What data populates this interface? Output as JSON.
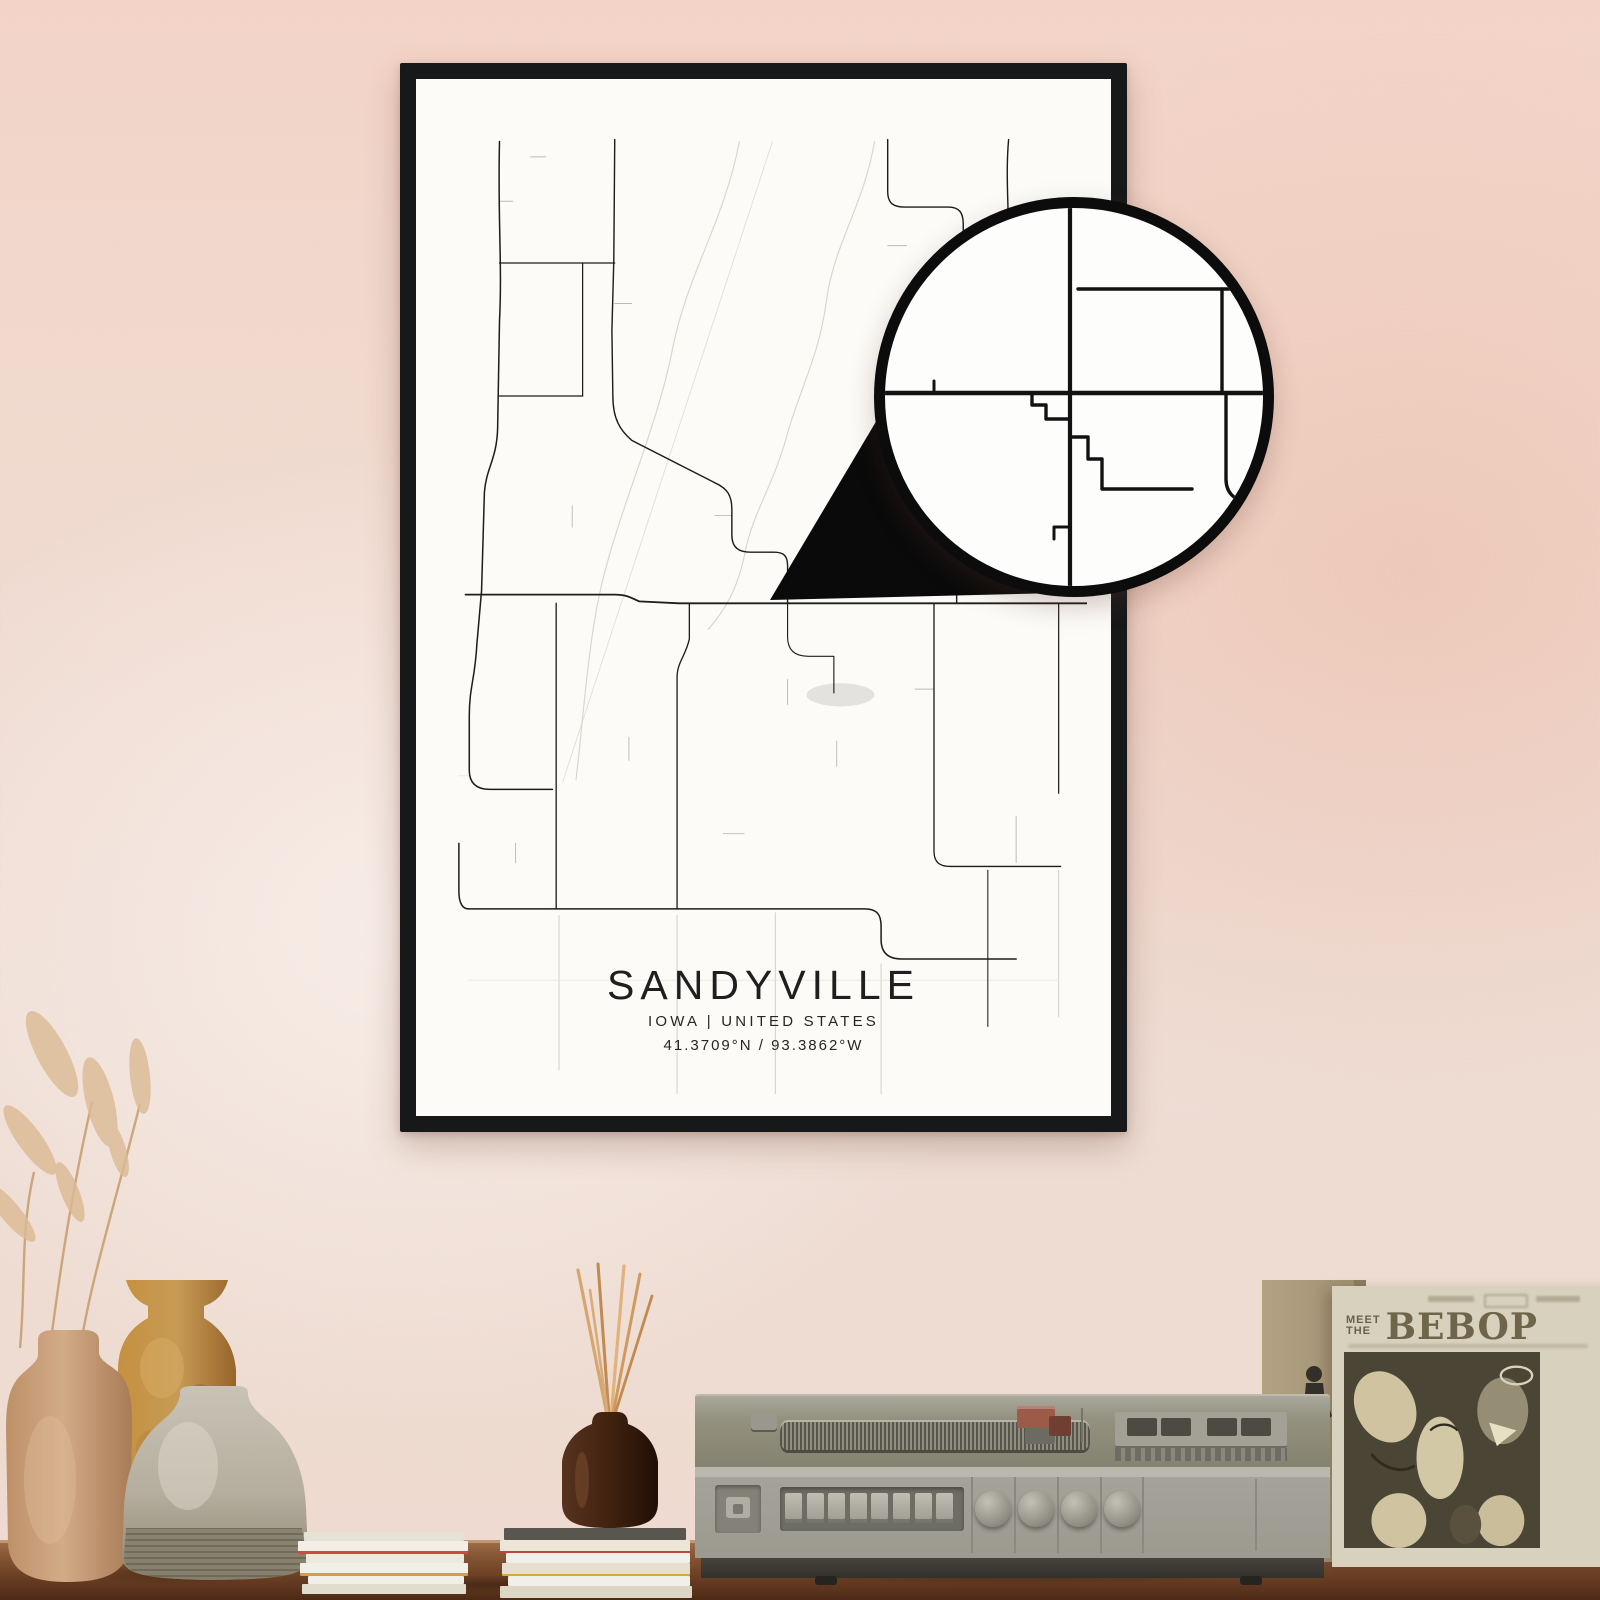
{
  "poster": {
    "title": "SANDYVILLE",
    "subtitle": "IOWA | UNITED STATES",
    "coordinates": "41.3709°N / 93.3862°W"
  },
  "record_sleeve": {
    "meet": "MEET",
    "the": "THE",
    "album": "BEBOP"
  },
  "colors": {
    "wall_top": "#f3d3c7",
    "wall_bottom": "#eedacf",
    "frame": "#17181a",
    "poster_bg": "#fcfbf8",
    "road": "#1d1d1b",
    "table_wood": "#8a5a38",
    "sleeve_cream": "#d8d1bd",
    "sleeve_panel": "#4a4535",
    "vase_tan": "#c49a75",
    "vase_ochre": "#c18a3c",
    "vase_gray": "#b5ae9f",
    "bottle_brown": "#3c2215",
    "player_gray": "#a5a399",
    "magnifier_ring": "#0c0c0d"
  },
  "map": {
    "colors": {
      "road": "#1d1d1b",
      "faint": "#bdbbb5",
      "light": "#cfcdc8",
      "creek": "#d9d5cd",
      "rail": "#e2dfda",
      "ghost": "#e7e5e0"
    },
    "pond": {
      "cx": 424,
      "cy": 616,
      "rx": 36,
      "ry": 12,
      "fill": "#e3e2de"
    },
    "roads": [
      {
        "d": "M63,42 C61,120 66,170 63,228 L61,340 C60,372 49,380 47,406 L44,508 L39,564 C37,600 31,608 31,638 L31,694 C31,708 39,714 53,714 L119,714",
        "w": 1.6
      },
      {
        "d": "M27,512 L185,512 C199,512 203,516 211,519 L253,521 L685,521",
        "w": 1.9
      },
      {
        "d": "M185,40 L184,166 L182,238 L183,306 C183,330 191,342 203,352 L291,396 C305,402 309,410 309,424 L309,450 C309,464 317,468 329,468 L354,468 C364,468 368,472 368,482 L368,521",
        "w": 1.5
      },
      {
        "d": "M63,168 L185,168",
        "w": 1.3
      },
      {
        "d": "M151,168 L151,306",
        "w": 1.3
      },
      {
        "d": "M63,306 L151,306",
        "w": 1.3
      },
      {
        "d": "M474,40 L474,94 C474,106 480,110 492,110 L538,110 C550,110 554,116 554,128 L554,158",
        "w": 1.5
      },
      {
        "d": "M602,40 C598,84 604,122 601,170 L602,260 C602,288 596,298 586,310 L559,340 C551,350 547,360 547,374 L547,521",
        "w": 1.5
      },
      {
        "d": "M123,521 L123,838",
        "w": 1.4
      },
      {
        "d": "M264,521 L264,558 C260,576 251,582 251,598 L251,838",
        "w": 1.4
      },
      {
        "d": "M368,521 L368,556 C368,570 376,576 390,576 L417,576 L417,614",
        "w": 1.2
      },
      {
        "d": "M30,838 L449,838 C463,838 467,844 467,856 L467,870 C467,884 475,890 489,890 L610,890",
        "w": 1.6
      },
      {
        "d": "M30,838 C24,838 20,832 20,820 L20,770",
        "w": 1.6
      },
      {
        "d": "M523,521 L523,778 C523,790 529,794 541,794 L657,794",
        "w": 1.4
      },
      {
        "d": "M655,521 L655,718",
        "w": 1.3
      },
      {
        "d": "M580,798 L580,960",
        "w": 1.1
      }
    ],
    "light_roads": [
      {
        "d": "M251,845 L251,1030",
        "w": 1.0
      },
      {
        "d": "M355,842 L355,1030",
        "w": 1.0
      },
      {
        "d": "M467,895 L467,1030",
        "w": 1.0
      },
      {
        "d": "M126,845 L126,1005",
        "w": 1.0
      },
      {
        "d": "M655,798 L655,950",
        "w": 1.0
      },
      {
        "d": "M30,912 L655,912",
        "w": 0.9,
        "ghost": true
      },
      {
        "d": "M30,700 L20,700",
        "w": 0.9,
        "ghost": true
      }
    ],
    "stub_roads": [
      {
        "d": "M96,58 L112,58",
        "w": 1
      },
      {
        "d": "M63,104 L77,104",
        "w": 1
      },
      {
        "d": "M185,210 L203,210",
        "w": 1
      },
      {
        "d": "M140,420 L140,442",
        "w": 1
      },
      {
        "d": "M309,430 L291,430",
        "w": 1
      },
      {
        "d": "M474,150 L494,150",
        "w": 1
      },
      {
        "d": "M602,210 L580,210",
        "w": 1
      },
      {
        "d": "M368,600 L368,626",
        "w": 1
      },
      {
        "d": "M523,610 L503,610",
        "w": 1
      },
      {
        "d": "M200,660 L200,684",
        "w": 1
      },
      {
        "d": "M80,770 L80,790",
        "w": 1
      },
      {
        "d": "M547,430 L565,430",
        "w": 1
      },
      {
        "d": "M420,690 L420,664",
        "w": 1
      },
      {
        "d": "M300,760 L322,760",
        "w": 1
      },
      {
        "d": "M610,742 L610,790",
        "w": 1
      }
    ],
    "creeks": [
      {
        "d": "M317,42 C300,128 262,178 246,258 C230,338 192,418 172,498 C157,558 152,638 144,704",
        "w": 1.2
      },
      {
        "d": "M460,42 C449,108 417,148 409,208 C401,266 381,298 367,348 C353,398 331,428 323,468 C315,508 300,530 284,548",
        "w": 1.2
      },
      {
        "d": "M610,340 C600,360 606,380 598,398",
        "w": 1
      }
    ],
    "rails": [
      {
        "d": "M352,42 L130,706",
        "w": 1
      }
    ],
    "zoom_roads": [
      {
        "d": "M196,6 L196,394",
        "w": 4.2
      },
      {
        "d": "M6,196 L394,196",
        "w": 4.6
      },
      {
        "d": "M158,196 L158,208 L172,208 L172,222 L196,222 L196,240 L214,240 L214,262 L228,262 L228,292 L318,292",
        "w": 3.4
      },
      {
        "d": "M204,92 L392,92",
        "w": 3.4
      },
      {
        "d": "M348,92 L348,196",
        "w": 3.4
      },
      {
        "d": "M352,196 L352,282 C352,296 360,302 372,306",
        "w": 3.4
      },
      {
        "d": "M60,196 L60,184",
        "w": 3
      },
      {
        "d": "M196,330 L180,330 L180,342",
        "w": 3
      }
    ]
  }
}
